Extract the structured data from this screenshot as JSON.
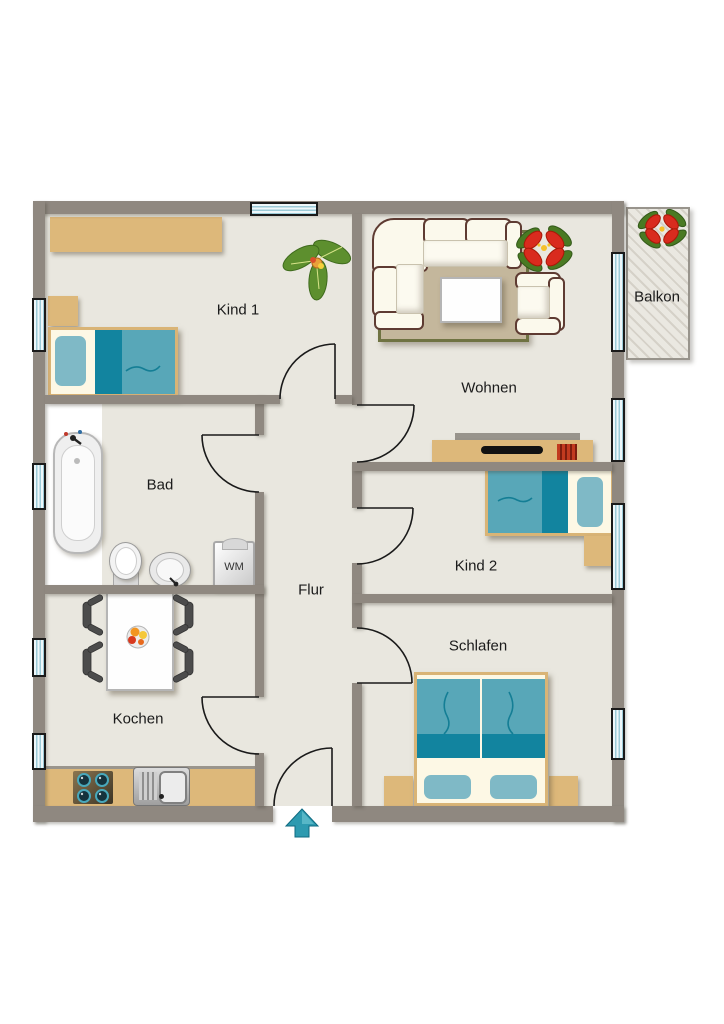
{
  "title": "Wohnungsgrundriss",
  "rooms": {
    "kind1": {
      "label": "Kind 1"
    },
    "wohnen": {
      "label": "Wohnen"
    },
    "balkon": {
      "label": "Balkon"
    },
    "bad": {
      "label": "Bad"
    },
    "kind2": {
      "label": "Kind 2"
    },
    "flur": {
      "label": "Flur"
    },
    "schlafen": {
      "label": "Schlafen"
    },
    "kochen": {
      "label": "Kochen"
    }
  },
  "appliances": {
    "washing_machine": "WM"
  },
  "colors": {
    "wall": "#8f8880",
    "floor": "#e9e7df",
    "furniture_wood": "#ddb87a",
    "bed_teal_light": "#58a7b8",
    "bed_teal_dark": "#12849f",
    "pillow_teal": "#7fb9c6",
    "window_glass": "#9ccbd8",
    "sofa_cream": "#fbf9ec",
    "rug": "#c4b79c",
    "rug_border": "#6f7342",
    "entrance_arrow": "#2d9ab0",
    "plant_green": "#5d8f2e",
    "flower_red": "#d92b1e"
  }
}
